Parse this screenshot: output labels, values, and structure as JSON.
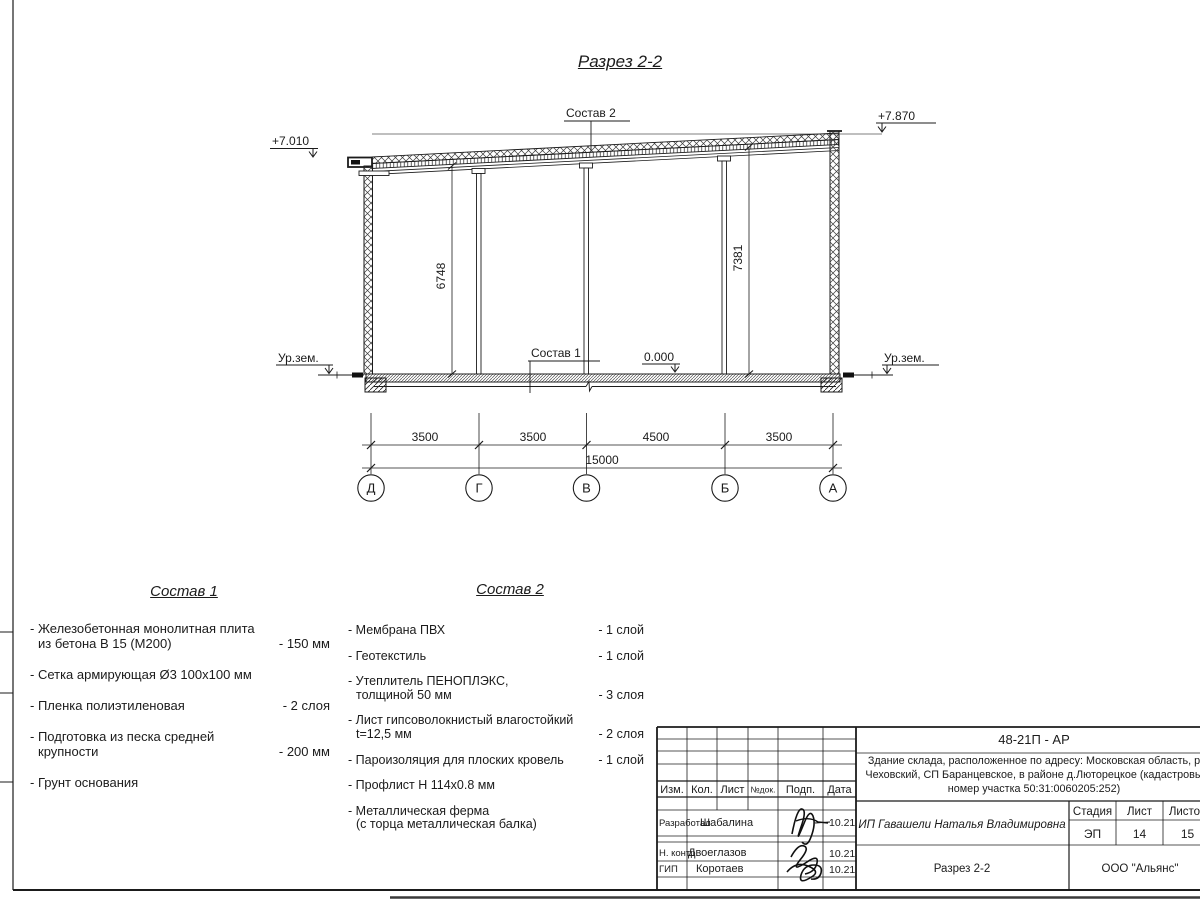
{
  "drawing": {
    "title": "Разрез 2-2",
    "labels": {
      "sostav2_callout": "Состав 2",
      "sostav1_callout": "Состав 1",
      "elev_left": "+7.010",
      "elev_right": "+7.870",
      "ground_left": "Ур.зем.",
      "ground_right": "Ур.зем.",
      "level_zero": "0.000",
      "dim_left_height": "6748",
      "dim_right_height": "7381"
    },
    "dims": {
      "d1": "3500",
      "d2": "3500",
      "d3": "4500",
      "d4": "3500",
      "total": "15000"
    },
    "axes": {
      "a1": "Д",
      "a2": "Г",
      "a3": "В",
      "a4": "Б",
      "a5": "А"
    }
  },
  "sostav1": {
    "title": "Состав 1",
    "items": [
      {
        "lines": [
          "- Железобетонная  монолитная плита",
          "из бетона В 15 (М200)"
        ],
        "value": "- 150 мм"
      },
      {
        "lines": [
          "- Сетка армирующая Ø3 100х100 мм"
        ],
        "value": ""
      },
      {
        "lines": [
          "- Пленка полиэтиленовая"
        ],
        "value": "-  2 слоя"
      },
      {
        "lines": [
          "- Подготовка из песка средней",
          "крупности"
        ],
        "value": "- 200 мм"
      },
      {
        "lines": [
          "- Грунт основания"
        ],
        "value": ""
      }
    ]
  },
  "sostav2": {
    "title": "Состав 2",
    "items": [
      {
        "lines": [
          "- Мембрана ПВХ"
        ],
        "value": "- 1 слой"
      },
      {
        "lines": [
          "- Геотекстиль"
        ],
        "value": "- 1 слой"
      },
      {
        "lines": [
          "- Утеплитель ПЕНОПЛЭКС,",
          "толщиной 50 мм"
        ],
        "value": "- 3 слоя"
      },
      {
        "lines": [
          "- Лист гипсоволокнистый влагостойкий",
          "t=12,5 мм"
        ],
        "value": "- 2 слоя"
      },
      {
        "lines": [
          "- Пароизоляция для плоских кровель"
        ],
        "value": "- 1 слой"
      },
      {
        "lines": [
          "- Профлист Н 114х0.8 мм"
        ],
        "value": ""
      },
      {
        "lines": [
          "- Металлическая ферма",
          "(с торца металлическая балка)"
        ],
        "value": ""
      }
    ]
  },
  "titleblock": {
    "code": "48-21П - АР",
    "description": [
      "Здание склада, расположенное по адресу: Московская область, р",
      "Чеховский, СП Баранцевское, в районе д.Люторецкое  (кадастровы",
      "номер участка 50:31:0060205:252)"
    ],
    "header": {
      "izm": "Изм.",
      "kol": "Кол.",
      "list": "Лист",
      "ndok": "№док.",
      "podp": "Подп.",
      "data": "Дата"
    },
    "rows": [
      {
        "role": "Разработал",
        "name": "Шабалина",
        "date": "10.21"
      },
      {
        "role": "Н. контр.",
        "name": "Двоеглазов",
        "date": "10.21"
      },
      {
        "role": "ГИП",
        "name": "Коротаев",
        "date": "10.21"
      }
    ],
    "client": "ИП Гавашели Наталья Владимировна",
    "stage_header": {
      "stage": "Стадия",
      "sheet": "Лист",
      "sheets": "Листов"
    },
    "stage_values": {
      "stage": "ЭП",
      "sheet": "14",
      "sheets": "15"
    },
    "doc_title": "Разрез 2-2",
    "company": "ООО \"Альянс\""
  }
}
